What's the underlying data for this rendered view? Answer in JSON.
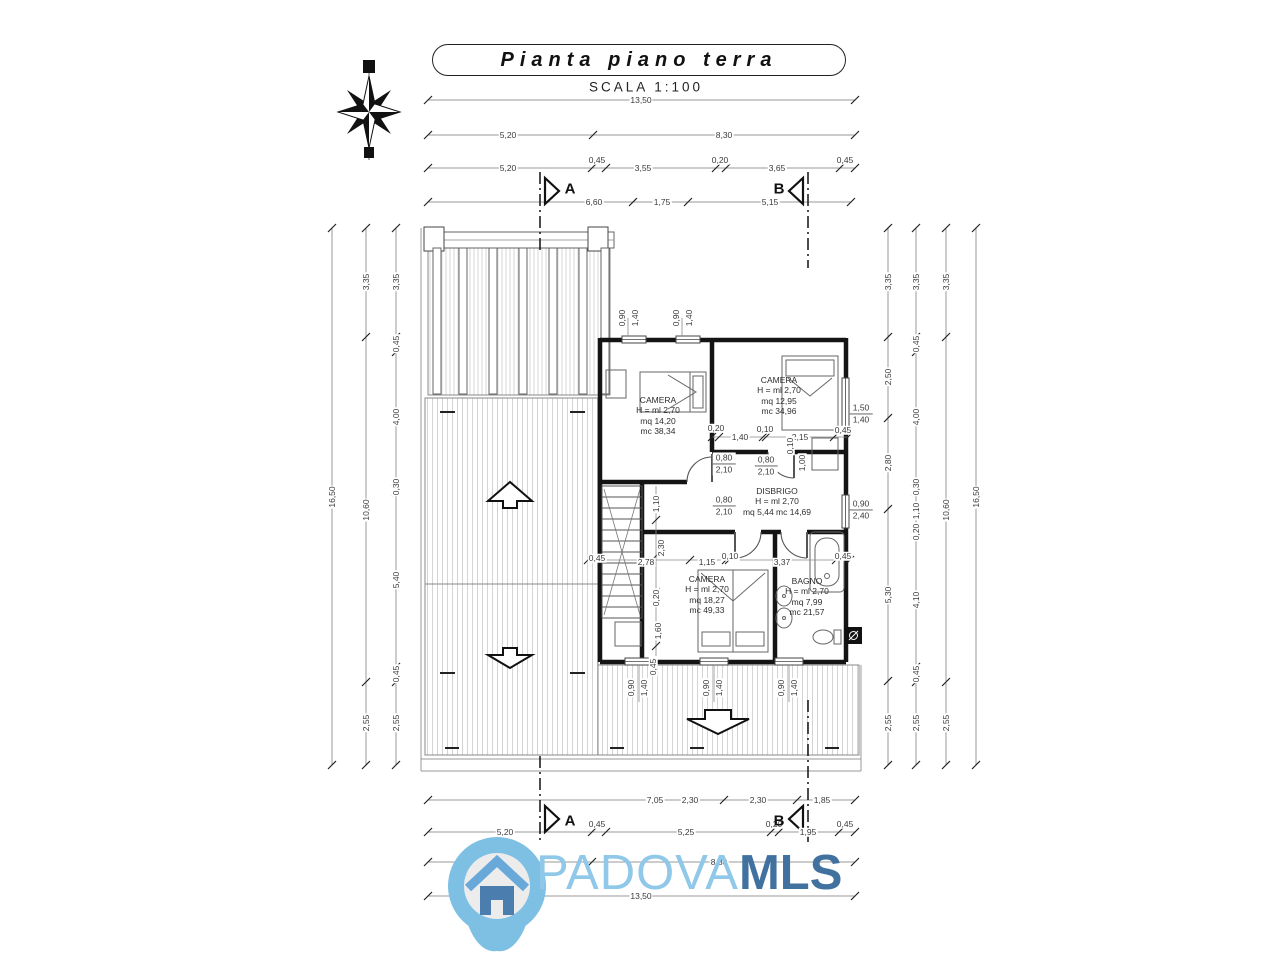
{
  "header": {
    "title": "Pianta piano terra",
    "scale": "SCALA   1:100"
  },
  "sections": {
    "a": "A",
    "b": "B"
  },
  "rooms": [
    {
      "name": "CAMERA",
      "h": "H = ml 2,70",
      "mq": "mq 14,20",
      "mc": "mc 38,34"
    },
    {
      "name": "CAMERA",
      "h": "H = ml 2,70",
      "mq": "mq 12,95",
      "mc": "mc 34,96"
    },
    {
      "name": "DISBRIGO",
      "h": "H = ml 2,70",
      "mqmc": "mq 5,44  mc 14,69"
    },
    {
      "name": "CAMERA",
      "h": "H = ml 2,70",
      "mq": "mq 18,27",
      "mc": "mc 49,33"
    },
    {
      "name": "BAGNO",
      "h": "H = ml 2,70",
      "mq": "mq 7,99",
      "mc": "mc 21,57"
    }
  ],
  "dims": {
    "t1": [
      "13,50"
    ],
    "t2": [
      "5,20",
      "8,30"
    ],
    "t3": [
      "5,20",
      "0,45",
      "3,55",
      "0,20",
      "3,65",
      "0,45"
    ],
    "t4": [
      "6,60",
      "1,75",
      "5,15"
    ],
    "b1": [
      "7,05",
      "2,30",
      "2,30",
      "1,85"
    ],
    "b2": [
      "5,20",
      "0,45",
      "5,25",
      "0,20",
      "1,95",
      "0,45"
    ],
    "b3": [
      "8,30"
    ],
    "b4": [
      "13,50"
    ],
    "l1": [
      "16,50"
    ],
    "l2": [
      "3,35",
      "10,60",
      "2,55"
    ],
    "l3": [
      "3,35",
      "0,45",
      "4,00",
      "0,30",
      "5,40",
      "0,45",
      "2,55"
    ],
    "r1": [
      "3,35",
      "2,50",
      "2,80",
      "5,30",
      "2,55"
    ],
    "r2": [
      "3,35",
      "0,45",
      "4,00",
      "0,30",
      "1,10",
      "0,20",
      "4,10",
      "0,45",
      "2,55"
    ],
    "r3": [
      "3,35",
      "10,60",
      "2,55"
    ],
    "r4": [
      "16,50"
    ],
    "door": {
      "w": "0,80",
      "h": "2,10"
    },
    "win": {
      "w": "0,90",
      "h": "1,40"
    },
    "win_right": {
      "w": "1,50",
      "h": "1,40"
    },
    "win_french": {
      "w": "0,90",
      "h": "2,40"
    },
    "plan": {
      "p020": "0,20",
      "p140": "1,40",
      "p010": "0,10",
      "p215": "2,15",
      "p100": "1,00",
      "p045": "0,45",
      "p278": "2,78",
      "p230": "2,30",
      "p115": "1,15",
      "p337": "3,37",
      "p160": "1,60",
      "p110": "1,10"
    }
  },
  "watermark": {
    "brand": "PADOVA",
    "brand_bold": "MLS",
    "colors": {
      "pin": "#7ec0e4",
      "inner": "#ececec",
      "roof": "#68a9d9",
      "house": "#4b7dae",
      "text_light": "#8fc8e8",
      "text_dark": "#41719f"
    }
  }
}
